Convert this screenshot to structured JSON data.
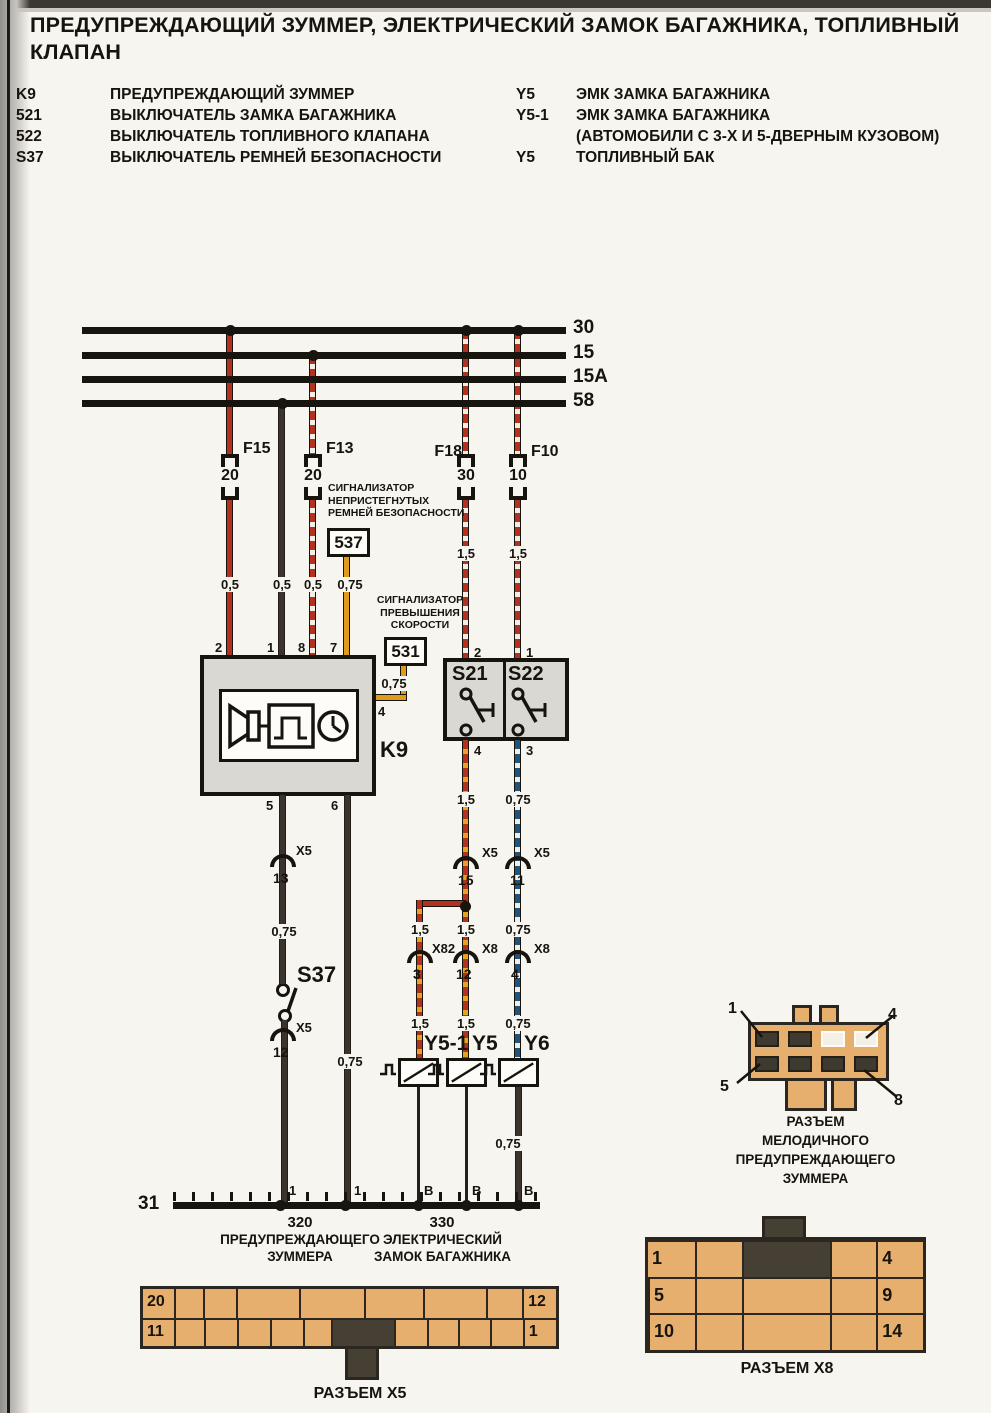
{
  "title": "ПРЕДУПРЕЖДАЮЩИЙ ЗУММЕР, ЭЛЕКТРИЧЕСКИЙ ЗАМОК БАГАЖНИКА, ТОПЛИВНЫЙ КЛАПАН",
  "legend": {
    "left": [
      {
        "code": "K9",
        "desc": "ПРЕДУПРЕЖДАЮЩИЙ ЗУММЕР"
      },
      {
        "code": "521",
        "desc": "ВЫКЛЮЧАТЕЛЬ ЗАМКА БАГАЖНИКА"
      },
      {
        "code": "522",
        "desc": "ВЫКЛЮЧАТЕЛЬ ТОПЛИВНОГО КЛАПАНА"
      },
      {
        "code": "S37",
        "desc": "ВЫКЛЮЧАТЕЛЬ РЕМНЕЙ БЕЗОПАСНОСТИ"
      }
    ],
    "right": [
      {
        "code": "Y5",
        "desc": "ЭМК ЗАМКА БАГАЖНИКА"
      },
      {
        "code": "Y5-1",
        "desc": "ЭМК ЗАМКА БАГАЖНИКА"
      },
      {
        "code": "",
        "desc": "(АВТОМОБИЛИ С 3-Х И 5-ДВЕРНЫМ КУЗОВОМ)"
      },
      {
        "code": "Y5",
        "desc": "ТОПЛИВНЫЙ БАК"
      }
    ]
  },
  "buses": {
    "b30": "30",
    "b15": "15",
    "b15a": "15A",
    "b58": "58",
    "b31": "31"
  },
  "fuses": [
    {
      "name": "F15",
      "rating": "20"
    },
    {
      "name": "F13",
      "rating": "20"
    },
    {
      "name": "F18",
      "rating": "30"
    },
    {
      "name": "F10",
      "rating": "10"
    }
  ],
  "signal_boxes": {
    "belts": {
      "id": "537",
      "caption": "СИГНАЛИЗАТОР\nНЕПРИСТЕГНУТЫХ\nРЕМНЕЙ БЕЗОПАСНОСТИ"
    },
    "speed": {
      "id": "531",
      "caption": "СИГНАЛИЗАТОР\nПРЕВЫШЕНИЯ\nСКОРОСТИ"
    }
  },
  "k9": {
    "label": "K9",
    "pin2": "2",
    "pin1": "1",
    "pin8": "8",
    "pin7": "7",
    "pin4": "4",
    "pin5": "5",
    "pin6": "6"
  },
  "s21": {
    "label": "S21",
    "pin_top": "2",
    "pin_bottom": "4"
  },
  "s22": {
    "label": "S22",
    "pin_top": "1",
    "pin_bottom": "3"
  },
  "s37": {
    "label": "S37"
  },
  "valves": {
    "y51": "Y5-1",
    "y5": "Y5",
    "y6": "Y6"
  },
  "conn_refs": {
    "x5_13": {
      "conn": "X5",
      "pin": "13"
    },
    "x5_12": {
      "conn": "X5",
      "pin": "12"
    },
    "x5_15": {
      "conn": "X5",
      "pin": "15"
    },
    "x5_11": {
      "conn": "X5",
      "pin": "11"
    },
    "x82_3": {
      "conn": "X82",
      "pin": "3"
    },
    "x8_12": {
      "conn": "X8",
      "pin": "12"
    },
    "x8_4": {
      "conn": "X8",
      "pin": "4"
    }
  },
  "gauges": {
    "w_f15": "0,5",
    "w_58": "0,5",
    "w_f13": "0,5",
    "w_537": "0,75",
    "w_531": "0,75",
    "w_f18": "1,5",
    "w_f10": "1,5",
    "w_s21_out": "1,5",
    "w_s22_out": "0,75",
    "w_s37": "0,75",
    "w_k9_6": "0,75",
    "w_y51_mid": "1,5",
    "w_y5_mid": "1,5",
    "w_y6_mid": "0,75",
    "w_y51_low": "1,5",
    "w_y5_low": "1,5",
    "w_y6_low": "0,75",
    "w_y6_gnd": "0,75"
  },
  "ground": {
    "pins": [
      "1",
      "1",
      "В",
      "В",
      "В"
    ],
    "points": [
      {
        "id": "320",
        "name": "ПРЕДУПРЕЖДАЮЩЕГО\nЗУММЕРА"
      },
      {
        "id": "330",
        "name": "ЭЛЕКТРИЧЕСКИЙ\nЗАМОК БАГАЖНИКА"
      }
    ]
  },
  "connectors": {
    "x5": {
      "title": "РАЗЪЕМ X5",
      "top_left": "20",
      "top_right": "12",
      "bottom_left": "11",
      "bottom_right": "1"
    },
    "x8": {
      "title": "РАЗЪЕМ X8",
      "cells": {
        "r1c1": "1",
        "r1c5": "4",
        "r2c1": "5",
        "r2c5": "9",
        "r3c1": "10",
        "r3c5": "14"
      }
    },
    "buzzer": {
      "title": "РАЗЪЕМ\nМЕЛОДИЧНОГО\nПРЕДУПРЕЖДАЮЩЕГО\nЗУММЕРА",
      "pin1": "1",
      "pin4": "4",
      "pin5": "5",
      "pin8": "8"
    }
  },
  "colors": {
    "wire_red": "#b5311f",
    "wire_black": "#3a342c",
    "wire_yellow": "#e09b1a",
    "stripe_white": "#f3efe7",
    "stripe_yellow": "#e8a31c",
    "wire_blue": "#20547c",
    "bus": "#17150d",
    "connector_fill": "#e6af6e",
    "connector_dark": "#464034",
    "box_fill": "#d9d8d3"
  }
}
